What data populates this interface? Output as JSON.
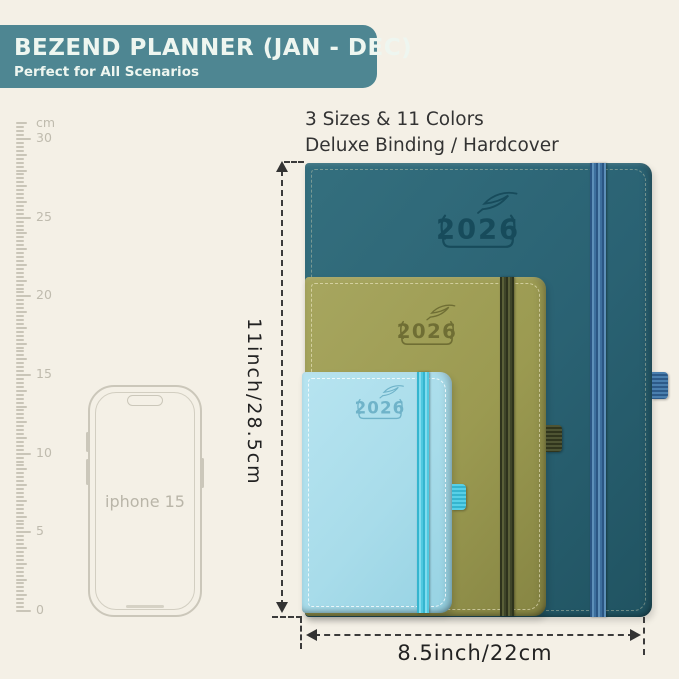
{
  "page": {
    "background": "#f4f0e6"
  },
  "header": {
    "title": "BEZEND PLANNER (JAN - DEC)",
    "subtitle": "Perfect for All Scenarios",
    "background": "#4e8692",
    "text_color": "#eef6f0"
  },
  "features": {
    "line1": "3 Sizes & 11 Colors",
    "line2": "Deluxe Binding / Hardcover"
  },
  "ruler": {
    "unit": "cm",
    "major_labels": [
      30,
      25,
      20,
      15,
      10,
      5,
      0
    ]
  },
  "phone": {
    "label": "iphone 15"
  },
  "planners": [
    {
      "id": "large",
      "year": "2026",
      "cover_color": "#2a6273",
      "band_color": "#4a7fae"
    },
    {
      "id": "medium",
      "year": "2026",
      "cover_color": "#9b9a51",
      "band_color": "#4e5433"
    },
    {
      "id": "small",
      "year": "2026",
      "cover_color": "#a8dcea",
      "band_color": "#55cfe6"
    }
  ],
  "dimensions": {
    "height_label": "11inch/28.5cm",
    "width_label": "8.5inch/22cm"
  }
}
